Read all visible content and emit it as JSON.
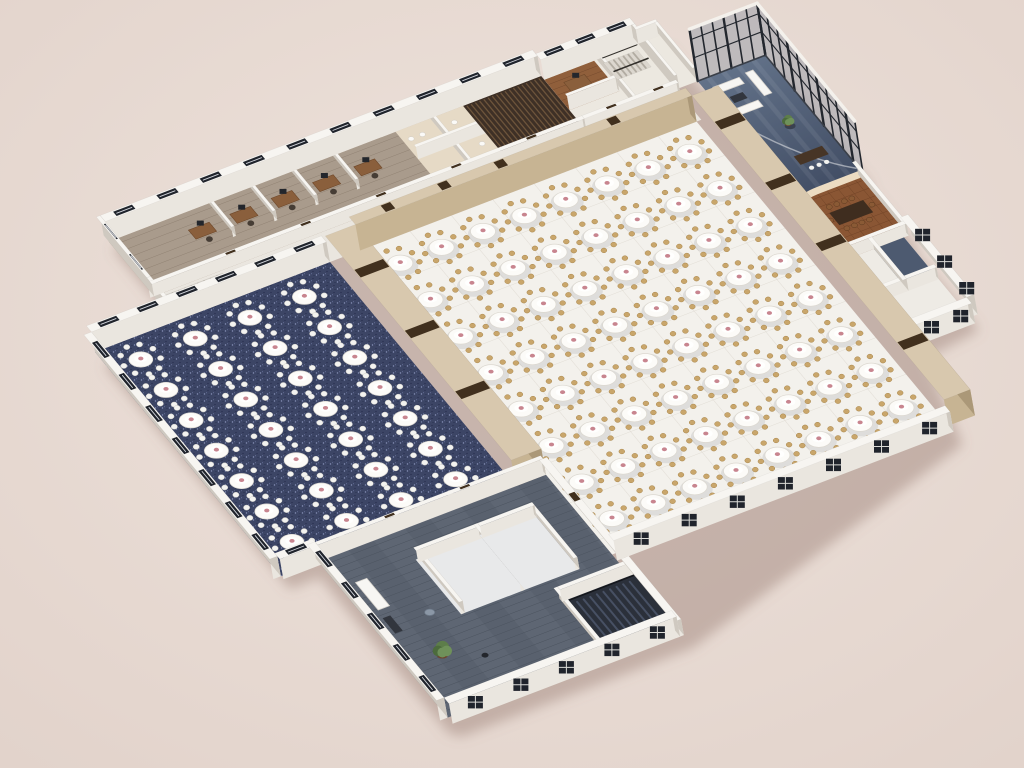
{
  "scene": {
    "width": 1024,
    "height": 768,
    "origin": [
      95,
      352
    ],
    "axisA": [
      0.94,
      -0.36
    ],
    "axisB": [
      0.63,
      0.76
    ],
    "shadow_offset": [
      9,
      13
    ]
  },
  "palette": {
    "bg1": "#eee3dc",
    "bg2": "#e2d3cb",
    "wallTop": "#f7f5f1",
    "wallSideL": "#eae6df",
    "wallSideD": "#cfc9c0",
    "winSlot": "#20242c",
    "winLine": "#d3d6dd",
    "tanTop": "#d8c8ae",
    "tanSideL": "#c7b493",
    "tanSideD": "#ab9878",
    "door": "#41301e",
    "marble": "#f3f1ec",
    "marbleLine": "#e1ddd5",
    "corridor": "#eae6df",
    "officeFloor": "#a99b8c",
    "plankLine": "rgba(78,62,48,0.28)",
    "restroom": "#e6dac6",
    "fixture": "#fbfaf7",
    "louver": "#3e3026",
    "louverLine": "#6d543b",
    "topCenterFloor": "#ece8e0",
    "woodRoom": "#905f3b",
    "woodLine": "rgba(58,32,14,0.32)",
    "lobbyA": "#67778e",
    "lobbyB": "#434f66",
    "streak": "rgba(255,255,255,0.07)",
    "glass": "rgba(106,122,144,0.33)",
    "mullion": "#23272e",
    "glassCap": "#f4f1ec",
    "vipWood": "#8a5634",
    "vipLine": "rgba(66,32,12,0.35)",
    "vipTable": "#3f2d1f",
    "vipChair": "#8a5a35",
    "cream": "#ecdcc2",
    "rightWingFloor": "#eeebe5",
    "darkCell": "#4d5a70",
    "navy": "#3c4565",
    "navySpk1": "#8690b6",
    "navySpk2": "#242b4a",
    "navySpk3": "#6d77a2",
    "lounge": "#59616e",
    "loungeDark": "#4a525e",
    "loungeLight": "#636c7a",
    "cloth": "#fcfbf8",
    "clothEdge": "#dcd8d0",
    "gold": "#c9a66b",
    "goldDark": "#a8854b",
    "whiteChair": "#f3f3f0",
    "whiteChairEdge": "#d2cfc8",
    "pink": "#c8858f",
    "stairFloor": "#dcd7cf",
    "stairTread": "#b2aca2",
    "rail": "#33302c",
    "stairDarkFloor": "#2b303a",
    "stairDarkTread": "#475063",
    "deskWood": "#8a5f3c",
    "deskEdge": "#6e482a",
    "monitor": "#23262c",
    "chairDark": "#463d35",
    "sofa": "#f7f6f3",
    "sofaEdge": "#d8d4cd",
    "coffee": "#32363e",
    "plantGreen1": "#5d7d4a",
    "plantGreen2": "#6f915a",
    "plantGreen3": "#4c6b3c",
    "pot": "#6e452c",
    "shadow": "rgba(142,116,106,0.40)"
  },
  "corridor": {
    "rect": [
      85,
      -33,
      645,
      0
    ]
  },
  "office": {
    "floor": [
      85,
      -105,
      545,
      -33
    ],
    "partitions": [
      190,
      234,
      278,
      322
    ],
    "desks": [
      168,
      212,
      256,
      300,
      344
    ],
    "deskV": -80,
    "restroom": {
      "floor": [
        390,
        -105,
        462,
        -33
      ],
      "wallU": [
        424,
        -105,
        427,
        -33
      ],
      "wallV": [
        390,
        -72,
        462,
        -69
      ],
      "fixtures": [
        [
          398,
          -92
        ],
        [
          410,
          -92
        ],
        [
          444,
          -92
        ],
        [
          452,
          -60
        ]
      ]
    },
    "louver": {
      "rect": [
        462,
        -105,
        545,
        -33
      ],
      "slatStep": 4.5
    }
  },
  "topCenter": {
    "floor": [
      545,
      -100,
      645,
      -33
    ],
    "cellWood": [
      545,
      -100,
      598,
      -60
    ],
    "walls": [
      [
        598,
        -100,
        601,
        -33
      ],
      [
        545,
        -63,
        598,
        -60
      ]
    ],
    "desk": [
      570,
      -84
    ],
    "stairs": {
      "rect": [
        604,
        -94,
        640,
        -72
      ],
      "axis": "u",
      "treads": 7
    }
  },
  "connector": {
    "floor": [
      645,
      -100,
      668,
      -40
    ]
  },
  "lobby": {
    "floor": [
      668,
      -40,
      740,
      115
    ],
    "glassNW": {
      "p1": [
        668,
        -40
      ],
      "p2": [
        740,
        -40
      ],
      "h": 52,
      "panels": 6
    },
    "glassNE": {
      "p1": [
        740,
        -40
      ],
      "p2": [
        740,
        115
      ],
      "h": 52,
      "panels": 10
    },
    "sofas": [
      [
        676,
        -28,
        704,
        -20
      ],
      [
        676,
        2,
        704,
        10
      ],
      [
        712,
        -30,
        720,
        0
      ]
    ],
    "coffee": [
      683,
      -12,
      697,
      -4
    ],
    "flowerTable": [
      714,
      38
    ],
    "reception": {
      "desk": [
        695,
        72,
        725,
        83
      ],
      "chairs": [
        [
          702,
          90
        ],
        [
          710,
          90
        ],
        [
          718,
          90
        ]
      ]
    },
    "arc": [
      [
        672,
        16
      ],
      [
        700,
        78
      ],
      [
        738,
        108
      ]
    ]
  },
  "vip": {
    "floor": [
      672,
      115,
      735,
      195
    ],
    "table": [
      686,
      142,
      722,
      158
    ],
    "chairs": [
      [
        690,
        136
      ],
      [
        698,
        136
      ],
      [
        706,
        136
      ],
      [
        714,
        136
      ],
      [
        690,
        164
      ],
      [
        698,
        164
      ],
      [
        706,
        164
      ],
      [
        714,
        164
      ],
      [
        682,
        150
      ],
      [
        726,
        150
      ]
    ],
    "curve": {
      "start": [
        672,
        195
      ],
      "corner1": [
        672,
        122
      ],
      "ctrl": [
        672,
        115
      ],
      "corner2": [
        694,
        115
      ],
      "end": [
        735,
        115
      ]
    },
    "wallE": [
      731,
      115,
      735,
      195
    ],
    "wallS": [
      672,
      191,
      735,
      195
    ]
  },
  "rightWing": {
    "floor": [
      668,
      195,
      730,
      300
    ],
    "darkCell": [
      698,
      195,
      730,
      246
    ],
    "innerWalls": [
      [
        668,
        246,
        730,
        250
      ],
      [
        694,
        195,
        698,
        250
      ]
    ],
    "winNE": {
      "rect": [
        730,
        195,
        738,
        300
      ],
      "axis": "v",
      "n": 3
    },
    "winSE": {
      "rect": [
        668,
        300,
        730,
        308
      ],
      "axis": "u",
      "n": 2
    }
  },
  "bands": {
    "W": {
      "rect": [
        250,
        0,
        282,
        295
      ],
      "h": 26,
      "doorsV": [
        50,
        130,
        210
      ]
    },
    "N": {
      "rect": [
        282,
        -10,
        640,
        0
      ],
      "h": 26,
      "doorsU": [
        320,
        380,
        440,
        560
      ]
    },
    "E": {
      "rect": [
        640,
        0,
        668,
        400
      ],
      "h": 26,
      "doorsV": [
        40,
        120,
        200,
        330
      ]
    }
  },
  "mainHall": {
    "floor": [
      282,
      0,
      640,
      400
    ],
    "tables": {
      "u0": 306,
      "du": 44,
      "nu": 8,
      "v0": 28,
      "dv": 48,
      "nv": 8,
      "chairs": 9,
      "chairRing": 17.5,
      "chairR": 2.9,
      "clothRx": 12.5,
      "clothRy": 8
    },
    "seWall": {
      "rect": [
        282,
        400,
        640,
        408
      ],
      "axis": "u",
      "n": 7
    }
  },
  "navyHall": {
    "floor": [
      0,
      0,
      250,
      295
    ],
    "tables": {
      "u0": 32,
      "du": 58,
      "nu": 4,
      "v0": 25,
      "dv": 40,
      "nv": 7,
      "chairs": 9,
      "chairRing": 18,
      "chairR": 3.1,
      "clothRx": 12,
      "clothRy": 7.6
    },
    "wallNW": {
      "rect": [
        0,
        -8,
        250,
        0
      ],
      "axis": "u",
      "n": 6
    },
    "wallSW": {
      "rect": [
        -8,
        0,
        0,
        295
      ],
      "axis": "v",
      "n": 7
    }
  },
  "lounge": {
    "floor": [
      40,
      295,
      282,
      500
    ],
    "rooms": [
      {
        "floor": [
          120,
          330,
          188,
          402
        ],
        "walls": [
          [
            120,
            330,
            124,
            402
          ],
          [
            120,
            330,
            188,
            334
          ],
          [
            184,
            330,
            188,
            402
          ]
        ]
      },
      {
        "floor": [
          188,
          330,
          246,
          402
        ],
        "walls": [
          [
            242,
            330,
            246,
            402
          ],
          [
            188,
            330,
            246,
            334
          ]
        ]
      }
    ],
    "stairwell": {
      "floor": [
        210,
        428,
        288,
        496
      ],
      "walls": [
        [
          206,
          424,
          210,
          496
        ],
        [
          210,
          424,
          288,
          428
        ]
      ],
      "treadU0": 215,
      "treadU1": 283,
      "treadStep": 7,
      "vIn": 434,
      "vOut": 490
    },
    "bench": [
      56,
      330,
      68,
      366
    ],
    "console": [
      54,
      376,
      62,
      396
    ],
    "roundTable": [
      96,
      388
    ],
    "plant": [
      80,
      432
    ],
    "smallTable": [
      112,
      452
    ],
    "wallNW": {
      "rect": [
        40,
        291,
        282,
        295
      ],
      "h": 16,
      "doorsU": [
        120,
        200
      ]
    },
    "wallNE": {
      "rect": [
        278,
        295,
        286,
        508
      ],
      "h": 16,
      "doorsV": [
        345,
        420
      ]
    },
    "jogNW": {
      "rect": [
        0,
        291,
        40,
        299
      ],
      "axis": "u",
      "n": 1
    },
    "winSW": {
      "rect": [
        32,
        295,
        40,
        500
      ],
      "axis": "v",
      "n": 5
    },
    "winSE": {
      "rect": [
        40,
        500,
        282,
        508
      ],
      "axis": "u",
      "n": 5
    }
  },
  "outerTopLeft": {
    "officeNW": {
      "rect": [
        85,
        -113,
        545,
        -105
      ],
      "axis": "u",
      "n": 10
    },
    "officeWcap": {
      "rect": [
        81,
        -113,
        85,
        -33
      ],
      "axis": "v",
      "n": 2
    },
    "corridorWcap": {
      "rect": [
        81,
        -33,
        85,
        0
      ],
      "axis": "v",
      "n": 0
    },
    "officeDivider": {
      "rect": [
        85,
        -37,
        545,
        -33
      ],
      "h": 12,
      "doorsU": [
        170,
        250,
        330,
        410,
        490
      ]
    },
    "tcNW": {
      "rect": [
        545,
        -108,
        645,
        -100
      ],
      "axis": "u",
      "n": 3
    },
    "tcEcap": {
      "rect": [
        642,
        -100,
        645,
        -33
      ],
      "axis": "v",
      "n": 0
    },
    "tcDivider": {
      "rect": [
        545,
        -37,
        645,
        -33
      ],
      "h": 12,
      "doorsU": [
        575,
        625
      ]
    },
    "connNW": {
      "rect": [
        645,
        -103,
        668,
        -100
      ],
      "axis": "u",
      "n": 0
    },
    "connE": {
      "rect": [
        665,
        -100,
        668,
        -40
      ],
      "axis": "v",
      "n": 0
    }
  },
  "corridorStairs": {
    "rect": [
      95,
      -30,
      156,
      -4
    ],
    "axis": "u",
    "treads": 9
  }
}
